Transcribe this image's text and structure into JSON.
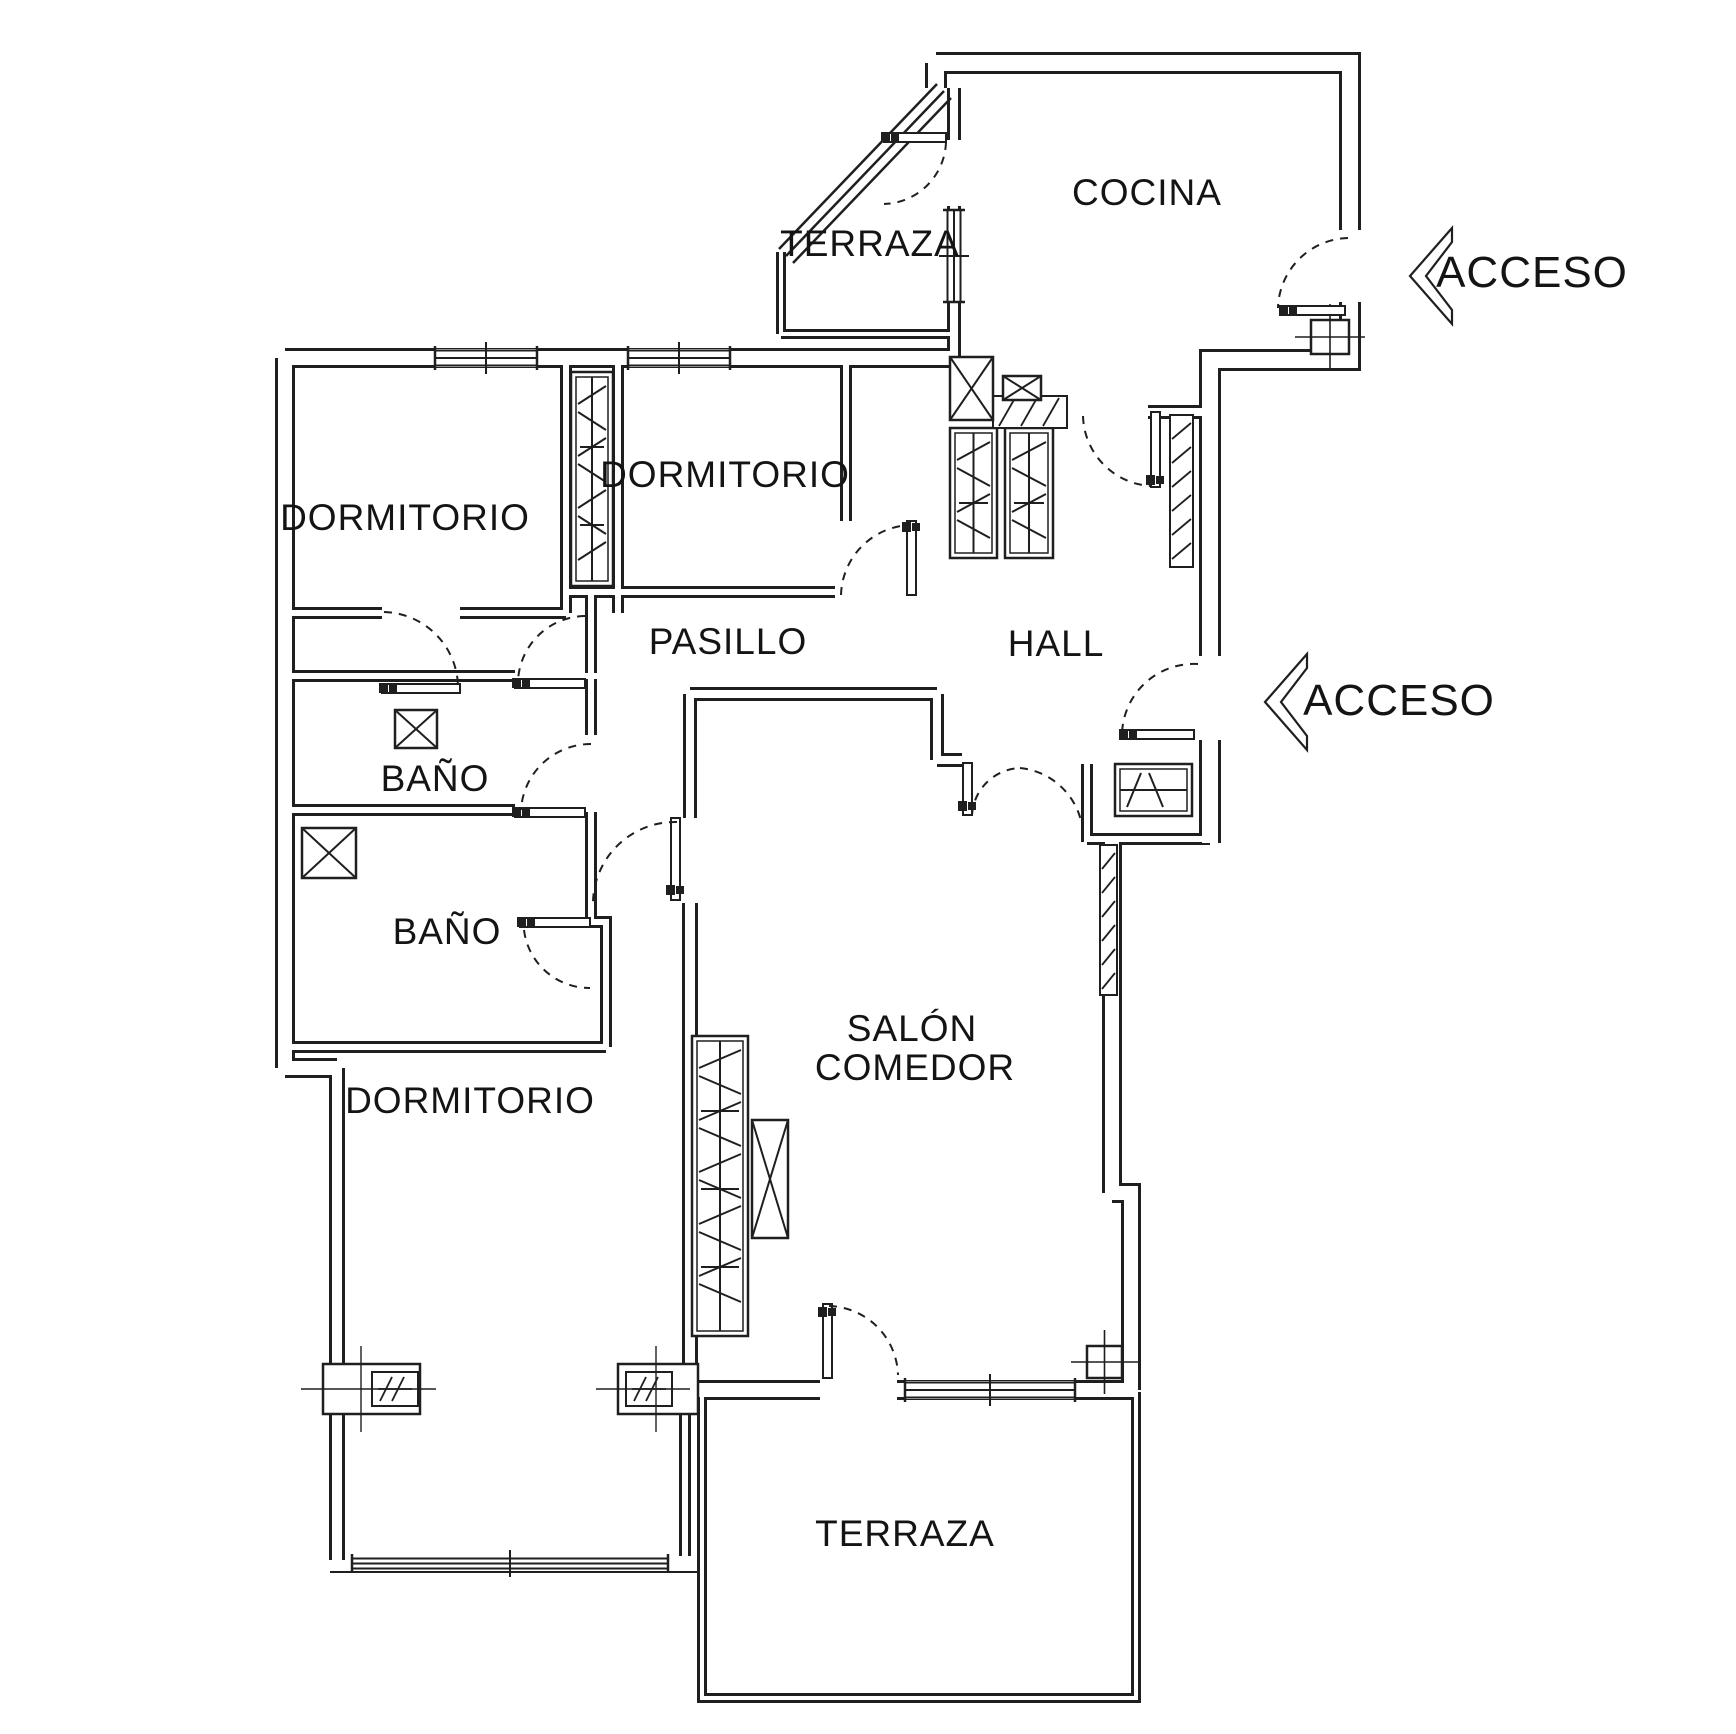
{
  "document": {
    "type": "floor-plan",
    "background": "#ffffff",
    "line_color": "#1f1f1f",
    "canvas": {
      "width": 1736,
      "height": 1734
    }
  },
  "labels": [
    {
      "name": "terraza-top-label",
      "text": "TERRAZA",
      "x": 870,
      "y": 256,
      "size": 37
    },
    {
      "name": "cocina-label",
      "text": "COCINA",
      "x": 1147,
      "y": 205,
      "size": 37
    },
    {
      "name": "acceso-top-label",
      "text": "ACCESO",
      "x": 1532,
      "y": 287,
      "size": 44
    },
    {
      "name": "dormitorio-1-label",
      "text": "DORMITORIO",
      "x": 405,
      "y": 530,
      "size": 37
    },
    {
      "name": "dormitorio-2-label",
      "text": "DORMITORIO",
      "x": 725,
      "y": 487,
      "size": 37
    },
    {
      "name": "pasillo-label",
      "text": "PASILLO",
      "x": 728,
      "y": 654,
      "size": 37
    },
    {
      "name": "hall-label",
      "text": "HALL",
      "x": 1056,
      "y": 656,
      "size": 37
    },
    {
      "name": "acceso-mid-label",
      "text": "ACCESO",
      "x": 1399,
      "y": 715,
      "size": 44
    },
    {
      "name": "bano-1-label",
      "text": "BAÑO",
      "x": 435,
      "y": 791,
      "size": 37
    },
    {
      "name": "bano-2-label",
      "text": "BAÑO",
      "x": 447,
      "y": 944,
      "size": 37
    },
    {
      "name": "salon-label-line1",
      "text": "SALÓN",
      "x": 912,
      "y": 1041,
      "size": 37
    },
    {
      "name": "salon-label-line2",
      "text": "COMEDOR",
      "x": 915,
      "y": 1080,
      "size": 37
    },
    {
      "name": "dormitorio-3-label",
      "text": "DORMITORIO",
      "x": 470,
      "y": 1113,
      "size": 37
    },
    {
      "name": "terraza-bottom-label",
      "text": "TERRAZA",
      "x": 905,
      "y": 1546,
      "size": 37
    }
  ],
  "walls": [
    {
      "d": "M936,63 H1350 V230",
      "t": 22
    },
    {
      "d": "M1350,302 V360 H1210 V656",
      "t": 22
    },
    {
      "d": "M936,63 V88",
      "t": 22
    },
    {
      "d": "M1148,412 H1210",
      "t": 14
    },
    {
      "d": "M285,358 H954",
      "t": 20
    },
    {
      "d": "M285,358 V1068",
      "t": 20
    },
    {
      "d": "M285,1068 H337",
      "t": 20
    },
    {
      "d": "M337,1068 V1560",
      "t": 16
    },
    {
      "d": "M781,252 V334",
      "t": 10
    },
    {
      "d": "M781,334 H954",
      "t": 10
    },
    {
      "d": "M954,88 V140",
      "t": 14
    },
    {
      "d": "M954,206 V358",
      "t": 14
    },
    {
      "d": "M566,358 V613",
      "t": 12
    },
    {
      "d": "M618,358 V613",
      "t": 12
    },
    {
      "d": "M846,358 V521",
      "t": 12
    },
    {
      "d": "M566,592 H835",
      "t": 12
    },
    {
      "d": "M285,613 H382",
      "t": 12
    },
    {
      "d": "M460,613 H566",
      "t": 12
    },
    {
      "d": "M285,676 H515",
      "t": 12
    },
    {
      "d": "M585,676 H597",
      "t": 12
    },
    {
      "d": "M591,592 V735",
      "t": 12
    },
    {
      "d": "M591,812 V922",
      "t": 12
    },
    {
      "d": "M591,922 H606 V1047",
      "t": 12
    },
    {
      "d": "M285,810 H515",
      "t": 12
    },
    {
      "d": "M285,1047 H606",
      "t": 12
    },
    {
      "d": "M690,694 H937",
      "t": 14
    },
    {
      "d": "M937,694 V760",
      "t": 14
    },
    {
      "d": "M937,760 H962",
      "t": 14
    },
    {
      "d": "M690,694 V818",
      "t": 14
    },
    {
      "d": "M690,903 V1390",
      "t": 16
    },
    {
      "d": "M1087,764 V842",
      "t": 12
    },
    {
      "d": "M1210,740 V843",
      "t": 22
    },
    {
      "d": "M1087,839 H1210",
      "t": 12
    },
    {
      "d": "M1112,842 V1193",
      "t": 20
    },
    {
      "d": "M1112,1193 H1131 V1390",
      "t": 20
    },
    {
      "d": "M680,1390 H820",
      "t": 20
    },
    {
      "d": "M897,1390 H1136",
      "t": 20
    },
    {
      "d": "M702,1395 V1698 H1136 V1392",
      "t": 10
    },
    {
      "d": "M685,1413 V1556",
      "t": 12
    }
  ],
  "glazing_diagonal": [
    [
      779,
      249,
      937,
      84
    ],
    [
      786,
      256,
      944,
      91
    ],
    [
      793,
      263,
      951,
      98
    ]
  ],
  "thin_lines": [
    [
      330,
      1572,
      700,
      1572
    ]
  ],
  "windows": [
    {
      "x": 435,
      "y": 349,
      "w": 102,
      "h": 18,
      "o": "h"
    },
    {
      "x": 628,
      "y": 349,
      "w": 102,
      "h": 18,
      "o": "h"
    },
    {
      "x": 946,
      "y": 210,
      "w": 16,
      "h": 92,
      "o": "v"
    },
    {
      "x": 905,
      "y": 1381,
      "w": 170,
      "h": 18,
      "o": "h"
    },
    {
      "x": 352,
      "y": 1557,
      "w": 316,
      "h": 13,
      "o": "h"
    }
  ],
  "doors": [
    {
      "name": "door-terraza-cocina",
      "leaf": [
        884,
        133,
        62,
        9
      ],
      "blob": [
        890,
        137
      ],
      "arcs": [
        "M946,142 A64,64 0 0 1 884,204"
      ]
    },
    {
      "name": "door-cocina-hall",
      "leaf": [
        1151,
        412,
        9,
        75
      ],
      "blob": [
        1155,
        480
      ],
      "arcs": [
        "M1083,416 A72,72 0 0 0 1151,486"
      ]
    },
    {
      "name": "door-acceso-cocina",
      "leaf": [
        1280,
        306,
        65,
        9
      ],
      "blob": [
        1288,
        310
      ],
      "arcs": [
        "M1348,238 A72,72 0 0 0 1278,308"
      ]
    },
    {
      "name": "door-acceso-hall",
      "leaf": [
        1120,
        730,
        74,
        9
      ],
      "blob": [
        1128,
        734
      ],
      "arcs": [
        "M1198,664 A72,72 0 0 0 1122,734"
      ]
    },
    {
      "name": "door-hall-salon",
      "leaf": [
        963,
        763,
        9,
        52
      ],
      "blob": [
        967,
        806
      ],
      "arcs": [
        "M972,815 A50,50 0 0 1 1020,768",
        "M1020,768 A70,70 0 0 1 1083,834"
      ]
    },
    {
      "name": "door-bano-1",
      "leaf": [
        515,
        679,
        70,
        9
      ],
      "blob": [
        521,
        683
      ],
      "arcs": [
        "M585,616 A68,68 0 0 0 518,681"
      ]
    },
    {
      "name": "door-bano-2",
      "leaf": [
        515,
        808,
        70,
        9
      ],
      "blob": [
        521,
        812
      ],
      "arcs": [
        "M591,744 A70,70 0 0 0 521,810"
      ]
    },
    {
      "name": "door-dormitorio-3",
      "leaf": [
        520,
        918,
        70,
        9
      ],
      "blob": [
        526,
        922
      ],
      "arcs": [
        "M524,930 A66,66 0 0 0 590,988"
      ]
    },
    {
      "name": "door-pasillo-salon",
      "leaf": [
        671,
        818,
        9,
        82
      ],
      "blob": [
        675,
        890
      ],
      "arcs": [
        "M677,822 A82,82 0 0 0 593,902"
      ]
    },
    {
      "name": "door-dormitorio-2",
      "leaf": [
        907,
        521,
        9,
        74
      ],
      "blob": [
        911,
        527
      ],
      "arcs": [
        "M841,595 A72,72 0 0 1 911,525"
      ]
    },
    {
      "name": "door-salon-terraza",
      "leaf": [
        823,
        1304,
        9,
        74
      ],
      "blob": [
        827,
        1312
      ],
      "arcs": [
        "M829,1306 A71,71 0 0 1 898,1375"
      ]
    },
    {
      "name": "door-dormitorio-1",
      "leaf": [
        382,
        684,
        78,
        9
      ],
      "blob": [
        388,
        688
      ],
      "arcs": [
        "M384,612 A76,76 0 0 1 458,686"
      ]
    }
  ],
  "closets": [
    {
      "x": 571,
      "y": 372,
      "w": 42,
      "h": 214,
      "o": "v"
    },
    {
      "x": 950,
      "y": 428,
      "w": 47,
      "h": 130,
      "o": "v"
    },
    {
      "x": 1005,
      "y": 428,
      "w": 48,
      "h": 130,
      "o": "v"
    },
    {
      "x": 1115,
      "y": 764,
      "w": 77,
      "h": 52,
      "o": "h"
    },
    {
      "x": 692,
      "y": 1036,
      "w": 56,
      "h": 300,
      "o": "v"
    }
  ],
  "hatch_blocks": [
    {
      "x": 993,
      "y": 396,
      "w": 74,
      "h": 32
    },
    {
      "x": 1170,
      "y": 415,
      "w": 23,
      "h": 152
    },
    {
      "x": 1100,
      "y": 845,
      "w": 17,
      "h": 150
    }
  ],
  "xboxes": [
    {
      "x": 950,
      "y": 357,
      "w": 43,
      "h": 63
    },
    {
      "x": 1003,
      "y": 376,
      "w": 38,
      "h": 24
    },
    {
      "x": 395,
      "y": 710,
      "w": 42,
      "h": 38
    },
    {
      "x": 302,
      "y": 828,
      "w": 54,
      "h": 50
    },
    {
      "x": 752,
      "y": 1120,
      "w": 36,
      "h": 118
    }
  ],
  "crossboxes": [
    {
      "x": 1311,
      "y": 320,
      "w": 38,
      "h": 34
    },
    {
      "x": 1087,
      "y": 1346,
      "w": 35,
      "h": 32
    }
  ],
  "pillars": [
    {
      "outer": [
        323,
        1364,
        97,
        50
      ],
      "inner": [
        372,
        1372,
        46,
        34
      ]
    },
    {
      "outer": [
        618,
        1364,
        80,
        50
      ],
      "inner": [
        626,
        1372,
        46,
        34
      ]
    }
  ],
  "chevrons": [
    {
      "name": "acceso-top-chevron",
      "d": "M1452,228 L1410,276 L1452,324 L1452,310 L1426,276 L1452,242 Z"
    },
    {
      "name": "acceso-mid-chevron",
      "d": "M1307,654 L1265,702 L1307,750 L1307,736 L1281,702 L1307,668 Z"
    }
  ]
}
